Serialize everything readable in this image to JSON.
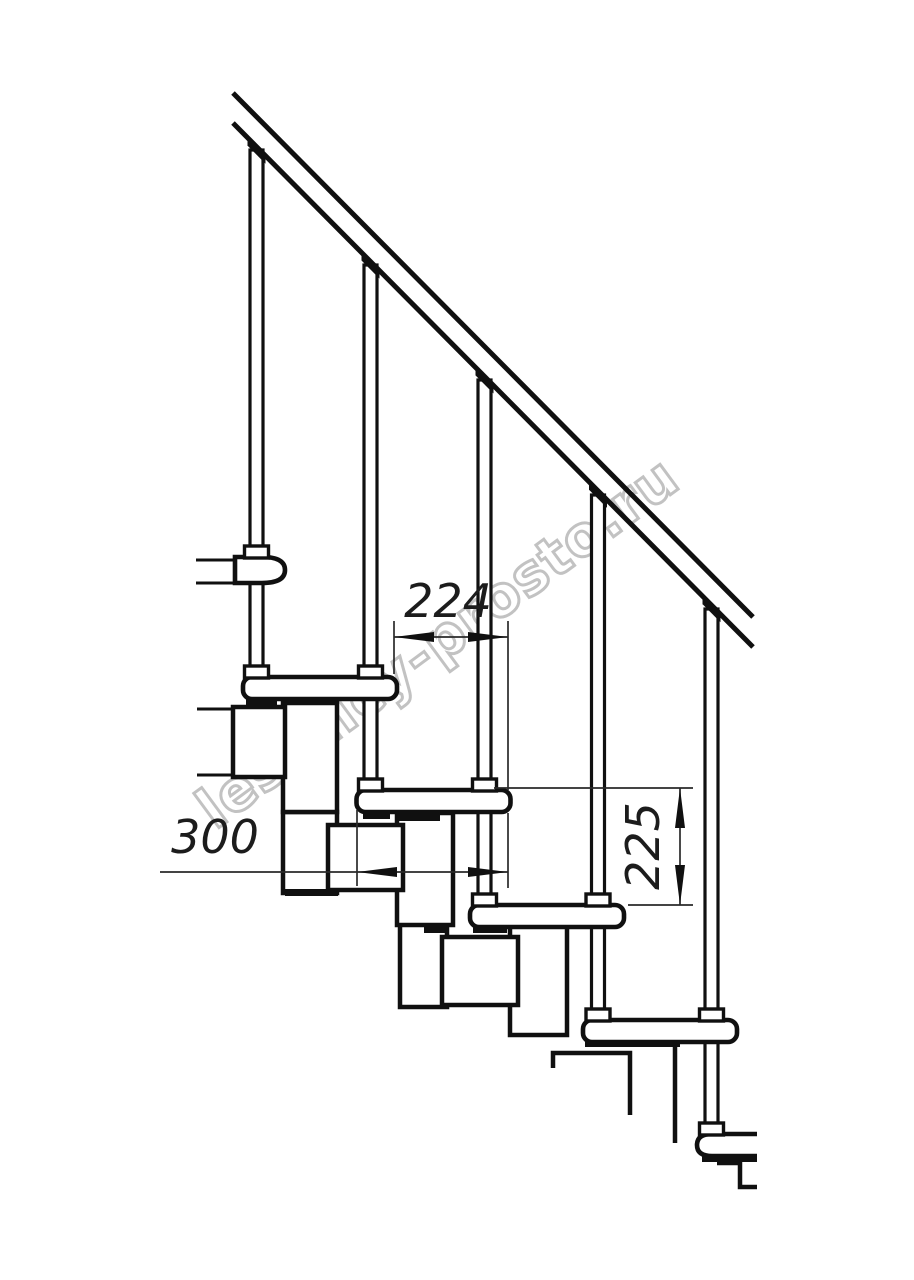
{
  "drawing": {
    "watermark": "lestnicy-prosto.ru",
    "dimensions": {
      "step_run": "224",
      "tread_depth": "300",
      "step_rise": "225"
    },
    "colors": {
      "line": "#101010",
      "dimension": "#1c1c1c",
      "watermark_outline": "#c2c2c2",
      "background": "#ffffff"
    }
  }
}
